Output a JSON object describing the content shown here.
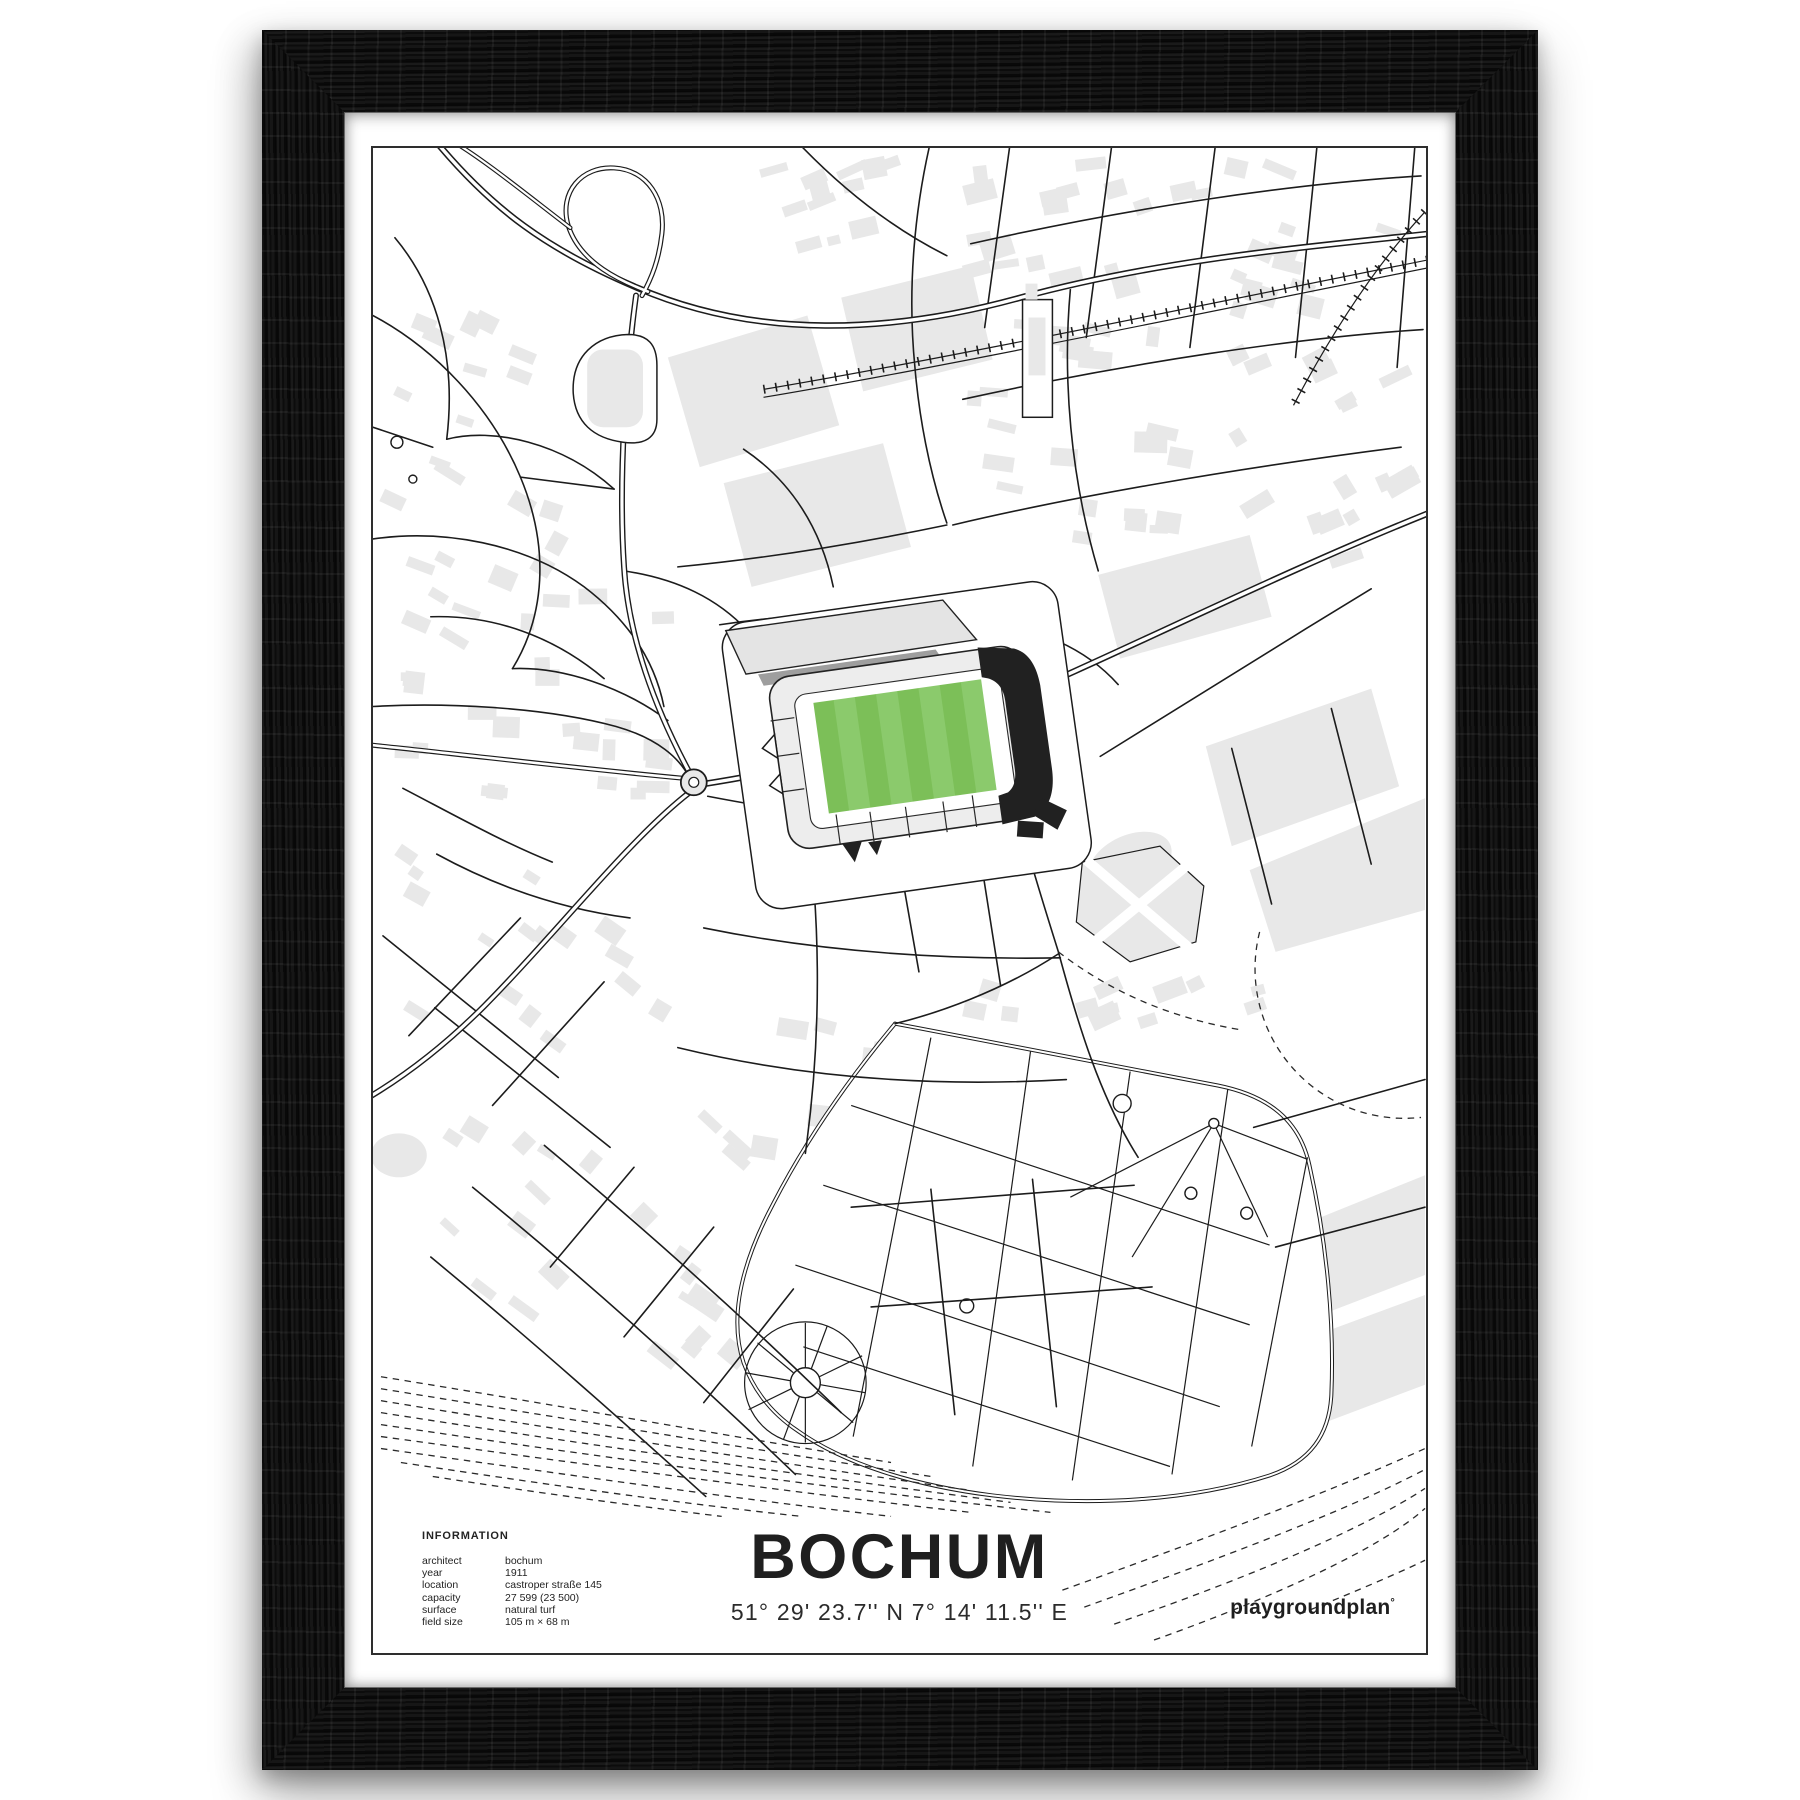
{
  "poster": {
    "title": "BOCHUM",
    "coordinates": "51° 29' 23.7'' N  7° 14' 11.5'' E",
    "brand": "playgroundplan",
    "brand_mark": "°",
    "info": {
      "heading": "INFORMATION",
      "rows": [
        {
          "label": "architect",
          "value": "bochum"
        },
        {
          "label": "year",
          "value": "1911"
        },
        {
          "label": "location",
          "value": "castroper straße 145"
        },
        {
          "label": "capacity",
          "value": "27 599 (23 500)"
        },
        {
          "label": "surface",
          "value": "natural turf"
        },
        {
          "label": "field size",
          "value": "105 m × 68 m"
        }
      ]
    }
  },
  "colors": {
    "frame": "#111111",
    "mat": "#ffffff",
    "map_border": "#2e2e2e",
    "road": "#1c1c1c",
    "building": "#e8e8e8",
    "pitch_green": "#7cbf58",
    "pitch_stripe": "#8bca6c",
    "stand_dark": "#212121",
    "roof_gray": "#9e9e9e",
    "text": "#232323"
  }
}
